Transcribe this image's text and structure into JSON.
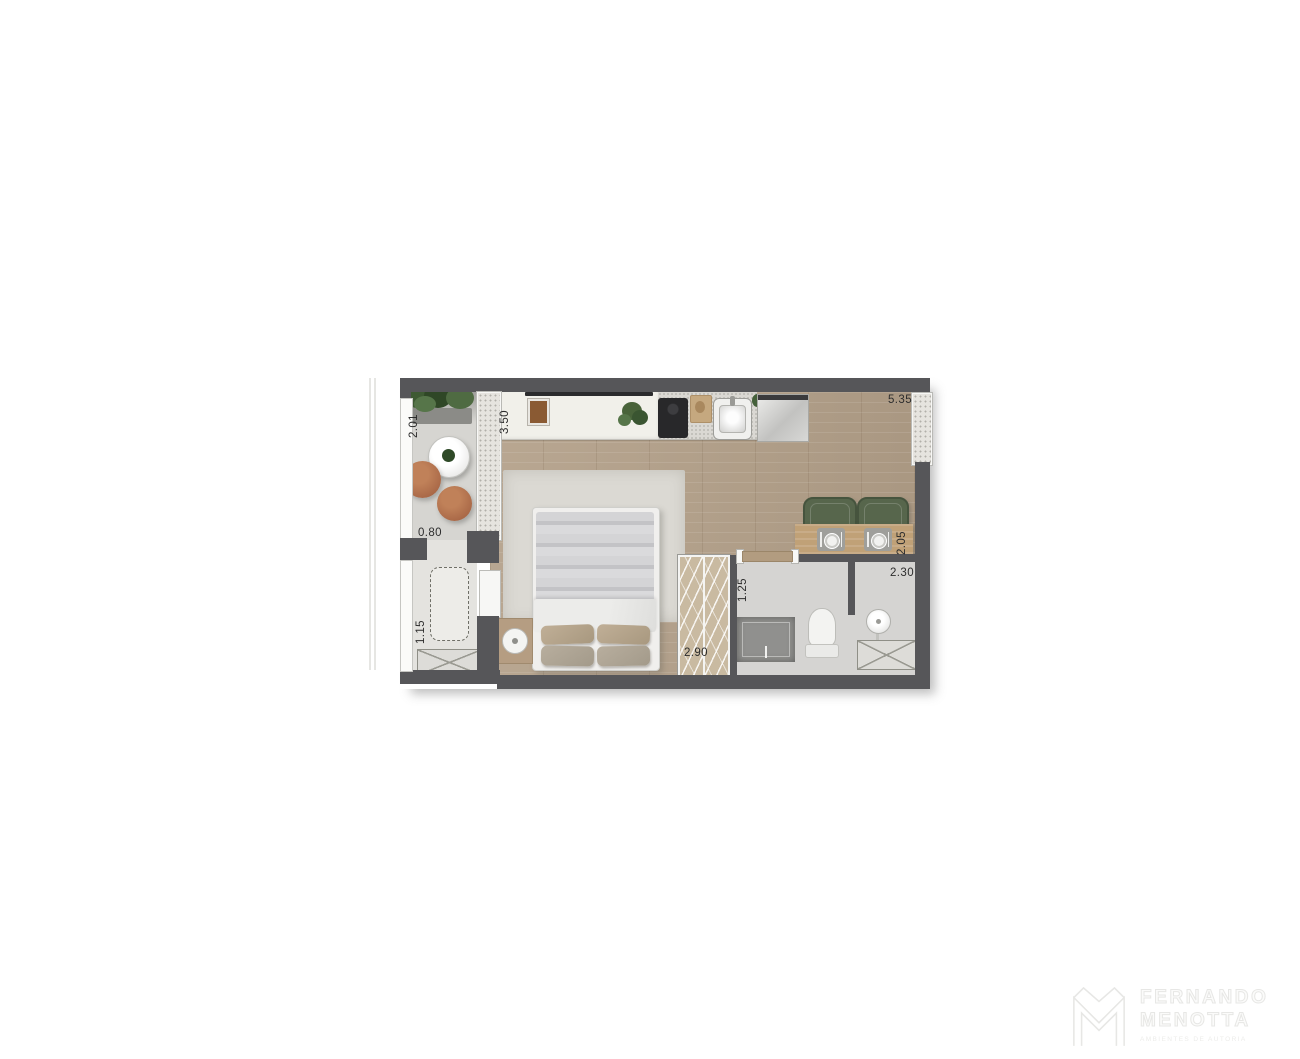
{
  "floor_plan": {
    "dimensions": {
      "balcony_depth": "2.01",
      "kitchen_run": "3.50",
      "living_length": "5.35",
      "passage_width": "0.80",
      "utility_width": "1.15",
      "wardrobe_run": "2.90",
      "bath_entry_width": "1.25",
      "bath_width": "2.30",
      "dining_depth": "2.05"
    },
    "rooms": {
      "balcony": "balcony with round table and poufs",
      "kitchen": "kitchen counter with cooktop, sink and fridge",
      "bedroom": "double bed on rug",
      "wardrobe": "hatched wardrobe strip",
      "bathroom": "shower, toilet and washbasin",
      "dining": "wall table with two chairs"
    },
    "colors": {
      "wall": "#565659",
      "wood_floor": "#b3a089",
      "balcony_floor": "#d6d5d1",
      "bath_floor": "#d5d4d2",
      "rug": "#dbd9d3",
      "wardrobe": "#c9baa1",
      "dining_table": "#c0a177",
      "chair_green": "#57664c",
      "pouf_terracotta": "#ac6c49"
    }
  },
  "branding": {
    "first_name": "FERNANDO",
    "last_name": "MENOTTA",
    "tagline": "AMBIENTES DE AUTORIA"
  }
}
